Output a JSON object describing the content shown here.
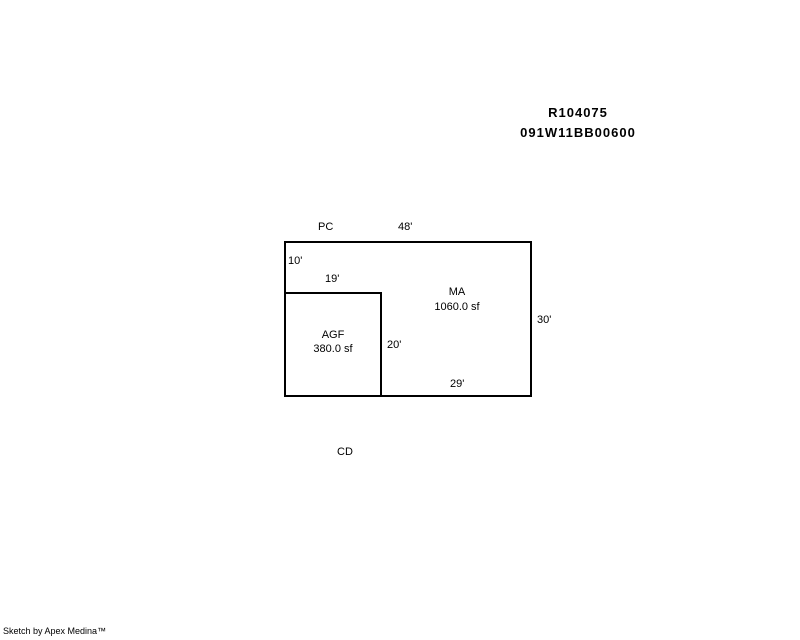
{
  "page": {
    "background_color": "#ffffff",
    "line_color": "#000000"
  },
  "header": {
    "record_id": "R104075",
    "parcel_id": "091W11BB00600"
  },
  "sketch": {
    "label_pc": "PC",
    "label_cd": "CD",
    "dim_top": "48'",
    "dim_left_upper": "10'",
    "dim_inner_top": "19'",
    "dim_right": "30'",
    "dim_inner_right": "20'",
    "dim_bottom": "29'",
    "ma_code": "MA",
    "ma_area": "1060.0 sf",
    "agf_code": "AGF",
    "agf_area": "380.0 sf"
  },
  "footer": {
    "credit": "Sketch by Apex Medina™"
  }
}
